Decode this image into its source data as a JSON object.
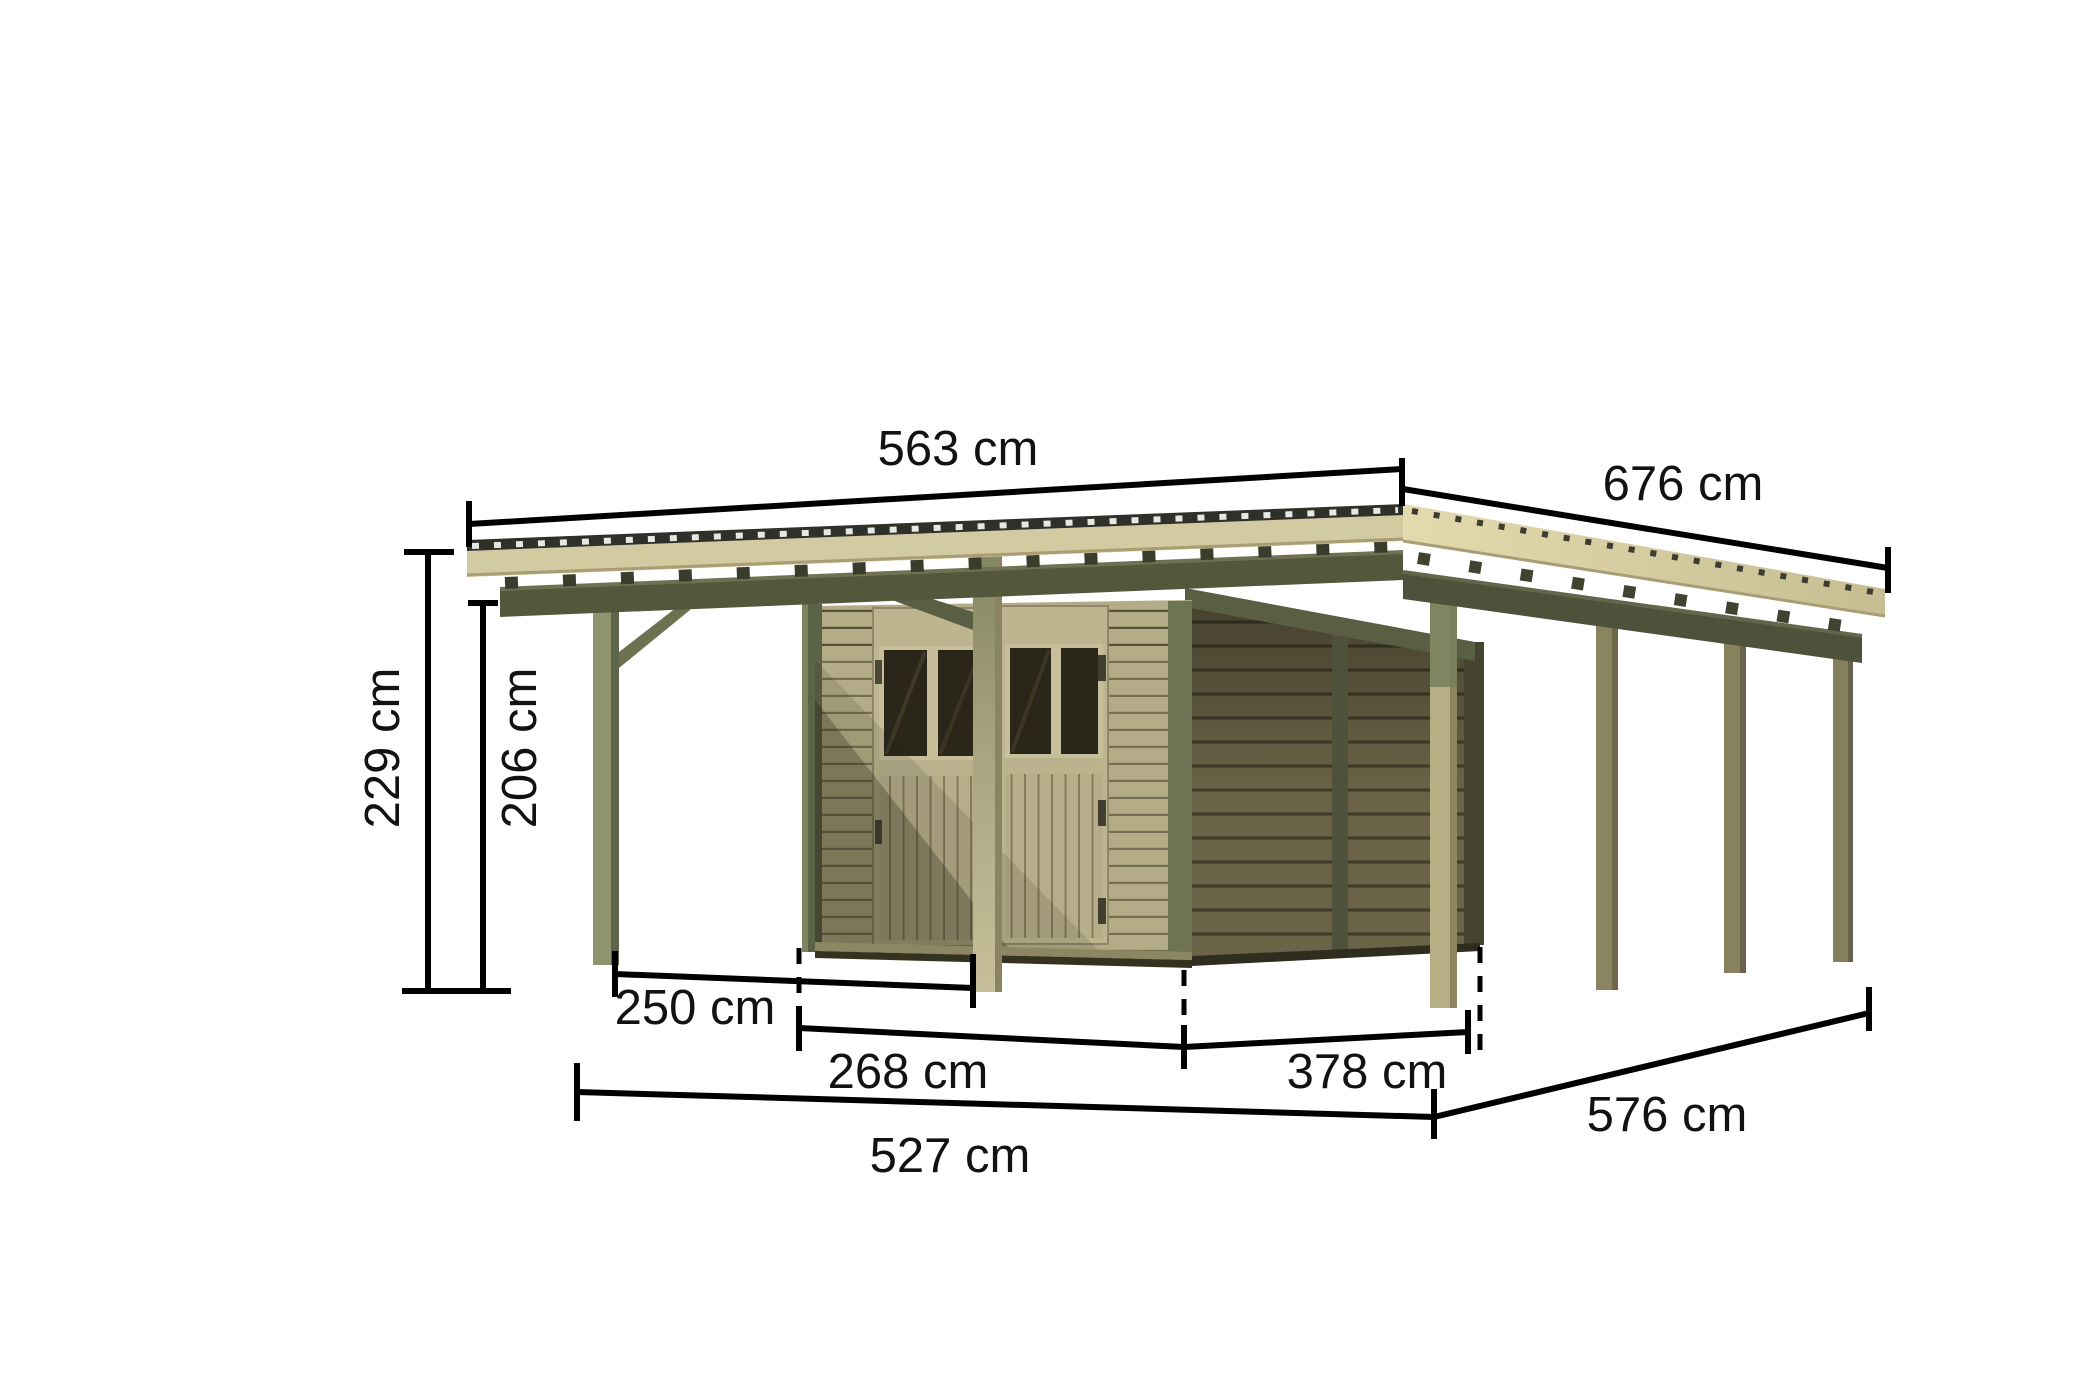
{
  "diagram": {
    "subject": "carport-with-storage-room-dimension-drawing",
    "unit": "cm",
    "dims": {
      "roof_front_width": "563 cm",
      "roof_side_depth": "676 cm",
      "total_height": "229 cm",
      "clearance_height": "206 cm",
      "left_bay_clear_width": "250 cm",
      "storeroom_front_width": "268 cm",
      "storeroom_side_depth": "378 cm",
      "front_overall_width": "527 cm",
      "side_overall_depth": "576 cm"
    },
    "colors": {
      "background": "#ffffff",
      "dimension_line": "#000000",
      "label_text": "#121212",
      "wood_light_fascia": "#d2caa0",
      "wood_roof_deck": "#e0d7ab",
      "wood_olive_beam": "#53573c",
      "wood_post_light": "#b6ae85",
      "wood_post_green": "#8f946f",
      "shed_front_wall": "#b3ac86",
      "shed_side_wall_shadow": "#6b6448",
      "door_window_pane": "#2b261a",
      "corrugated_roof_edge": "#30302a"
    }
  }
}
